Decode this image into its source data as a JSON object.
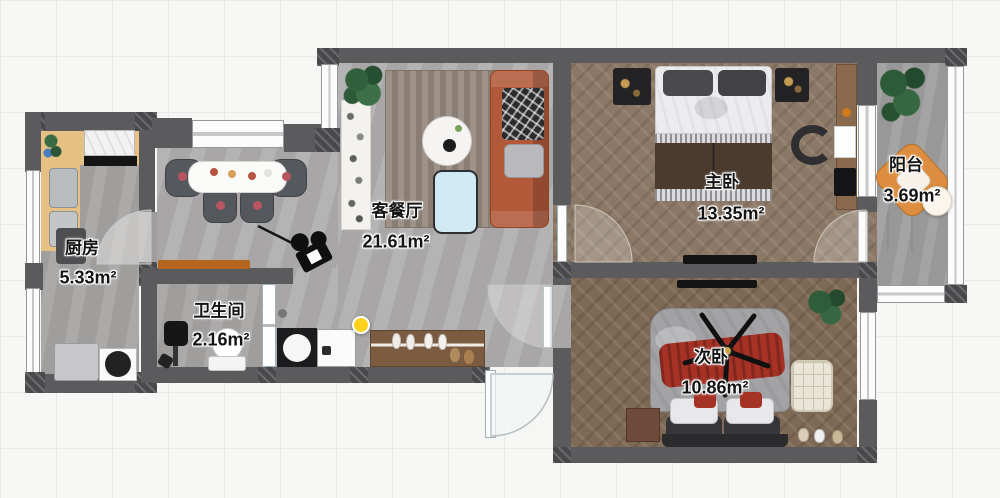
{
  "rooms": [
    {
      "id": "kitchen",
      "name": "厨房",
      "area": "5.33m²"
    },
    {
      "id": "bathroom",
      "name": "卫生间",
      "area": "2.16m²"
    },
    {
      "id": "living-dining",
      "name": "客餐厅",
      "area": "21.61m²"
    },
    {
      "id": "master-bedroom",
      "name": "主卧",
      "area": "13.35m²"
    },
    {
      "id": "second-bedroom",
      "name": "次卧",
      "area": "10.86m²"
    },
    {
      "id": "balcony",
      "name": "阳台",
      "area": "3.69m²"
    }
  ],
  "markers": {
    "camera": "camera-view-marker",
    "highlight": "yellow-point-marker"
  },
  "colors": {
    "wall": "#5b5b5e",
    "stone_floor": "#afadae",
    "wood_floor_master": "#8c7866",
    "wood_floor_second": "#7e6955",
    "balcony_floor": "#9e9e9f",
    "sofa": "#b2593a",
    "accent_red": "#a63226",
    "marker_yellow": "#ffd21e",
    "balcony_chair": "#dd8d3f",
    "kitchen_counter": "#e7c084",
    "console": "#b5651d"
  }
}
